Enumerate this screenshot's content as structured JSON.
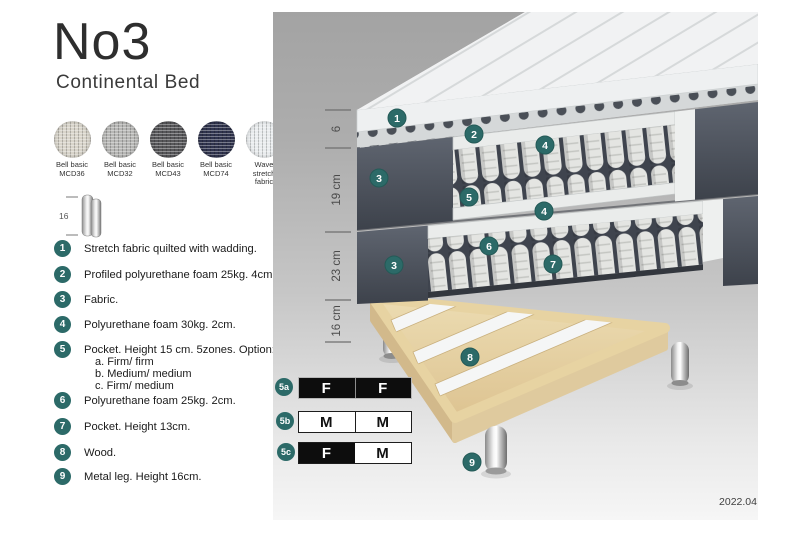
{
  "page": {
    "version_label": "2022.04"
  },
  "header": {
    "title": "No3",
    "subtitle": "Continental Bed"
  },
  "swatches": [
    {
      "name": "Bell basic MCD36",
      "label_line1": "Bell basic",
      "label_line2": "MCD36",
      "color": "#d8d4ca"
    },
    {
      "name": "Bell basic MCD32",
      "label_line1": "Bell basic",
      "label_line2": "MCD32",
      "color": "#b7b7b5"
    },
    {
      "name": "Bell basic MCD43",
      "label_line1": "Bell basic",
      "label_line2": "MCD43",
      "color": "#57575a"
    },
    {
      "name": "Bell basic MCD74",
      "label_line1": "Bell basic",
      "label_line2": "MCD74",
      "color": "#30344e"
    },
    {
      "name": "Wave stretch fabric",
      "label_line1": "Wave",
      "label_line2": "stretch fabric",
      "color": "#e9ecee"
    }
  ],
  "leg_spec": {
    "height_label": "16"
  },
  "legend": [
    {
      "num": "1",
      "text": "Stretch fabric quilted with wadding."
    },
    {
      "num": "2",
      "text": "Profiled polyurethane foam 25kg. 4cm."
    },
    {
      "num": "3",
      "text": "Fabric."
    },
    {
      "num": "4",
      "text": "Polyurethane foam 30kg. 2cm."
    },
    {
      "num": "5",
      "text": "Pocket. Height 15 cm. 5zones. Option:",
      "options": [
        "a. Firm/ firm",
        "b. Medium/ medium",
        "c. Firm/ medium"
      ]
    },
    {
      "num": "6",
      "text": "Polyurethane foam 25kg. 2cm."
    },
    {
      "num": "7",
      "text": "Pocket. Height 13cm."
    },
    {
      "num": "8",
      "text": "Wood."
    },
    {
      "num": "9",
      "text": "Metal leg. Height 16cm."
    }
  ],
  "diagram": {
    "dimensions": [
      "6",
      "19 cm",
      "23 cm",
      "16 cm"
    ],
    "callouts": [
      "1",
      "2",
      "4",
      "3",
      "5",
      "4",
      "6",
      "7",
      "3",
      "8",
      "9"
    ],
    "accent_color": "#2c6a68"
  },
  "firmness_table": {
    "rows": [
      {
        "id": "5a",
        "cells": [
          {
            "label": "F",
            "fill": "dark"
          },
          {
            "label": "F",
            "fill": "dark"
          }
        ]
      },
      {
        "id": "5b",
        "cells": [
          {
            "label": "M",
            "fill": "light"
          },
          {
            "label": "M",
            "fill": "light"
          }
        ]
      },
      {
        "id": "5c",
        "cells": [
          {
            "label": "F",
            "fill": "dark"
          },
          {
            "label": "M",
            "fill": "light"
          }
        ]
      }
    ]
  }
}
